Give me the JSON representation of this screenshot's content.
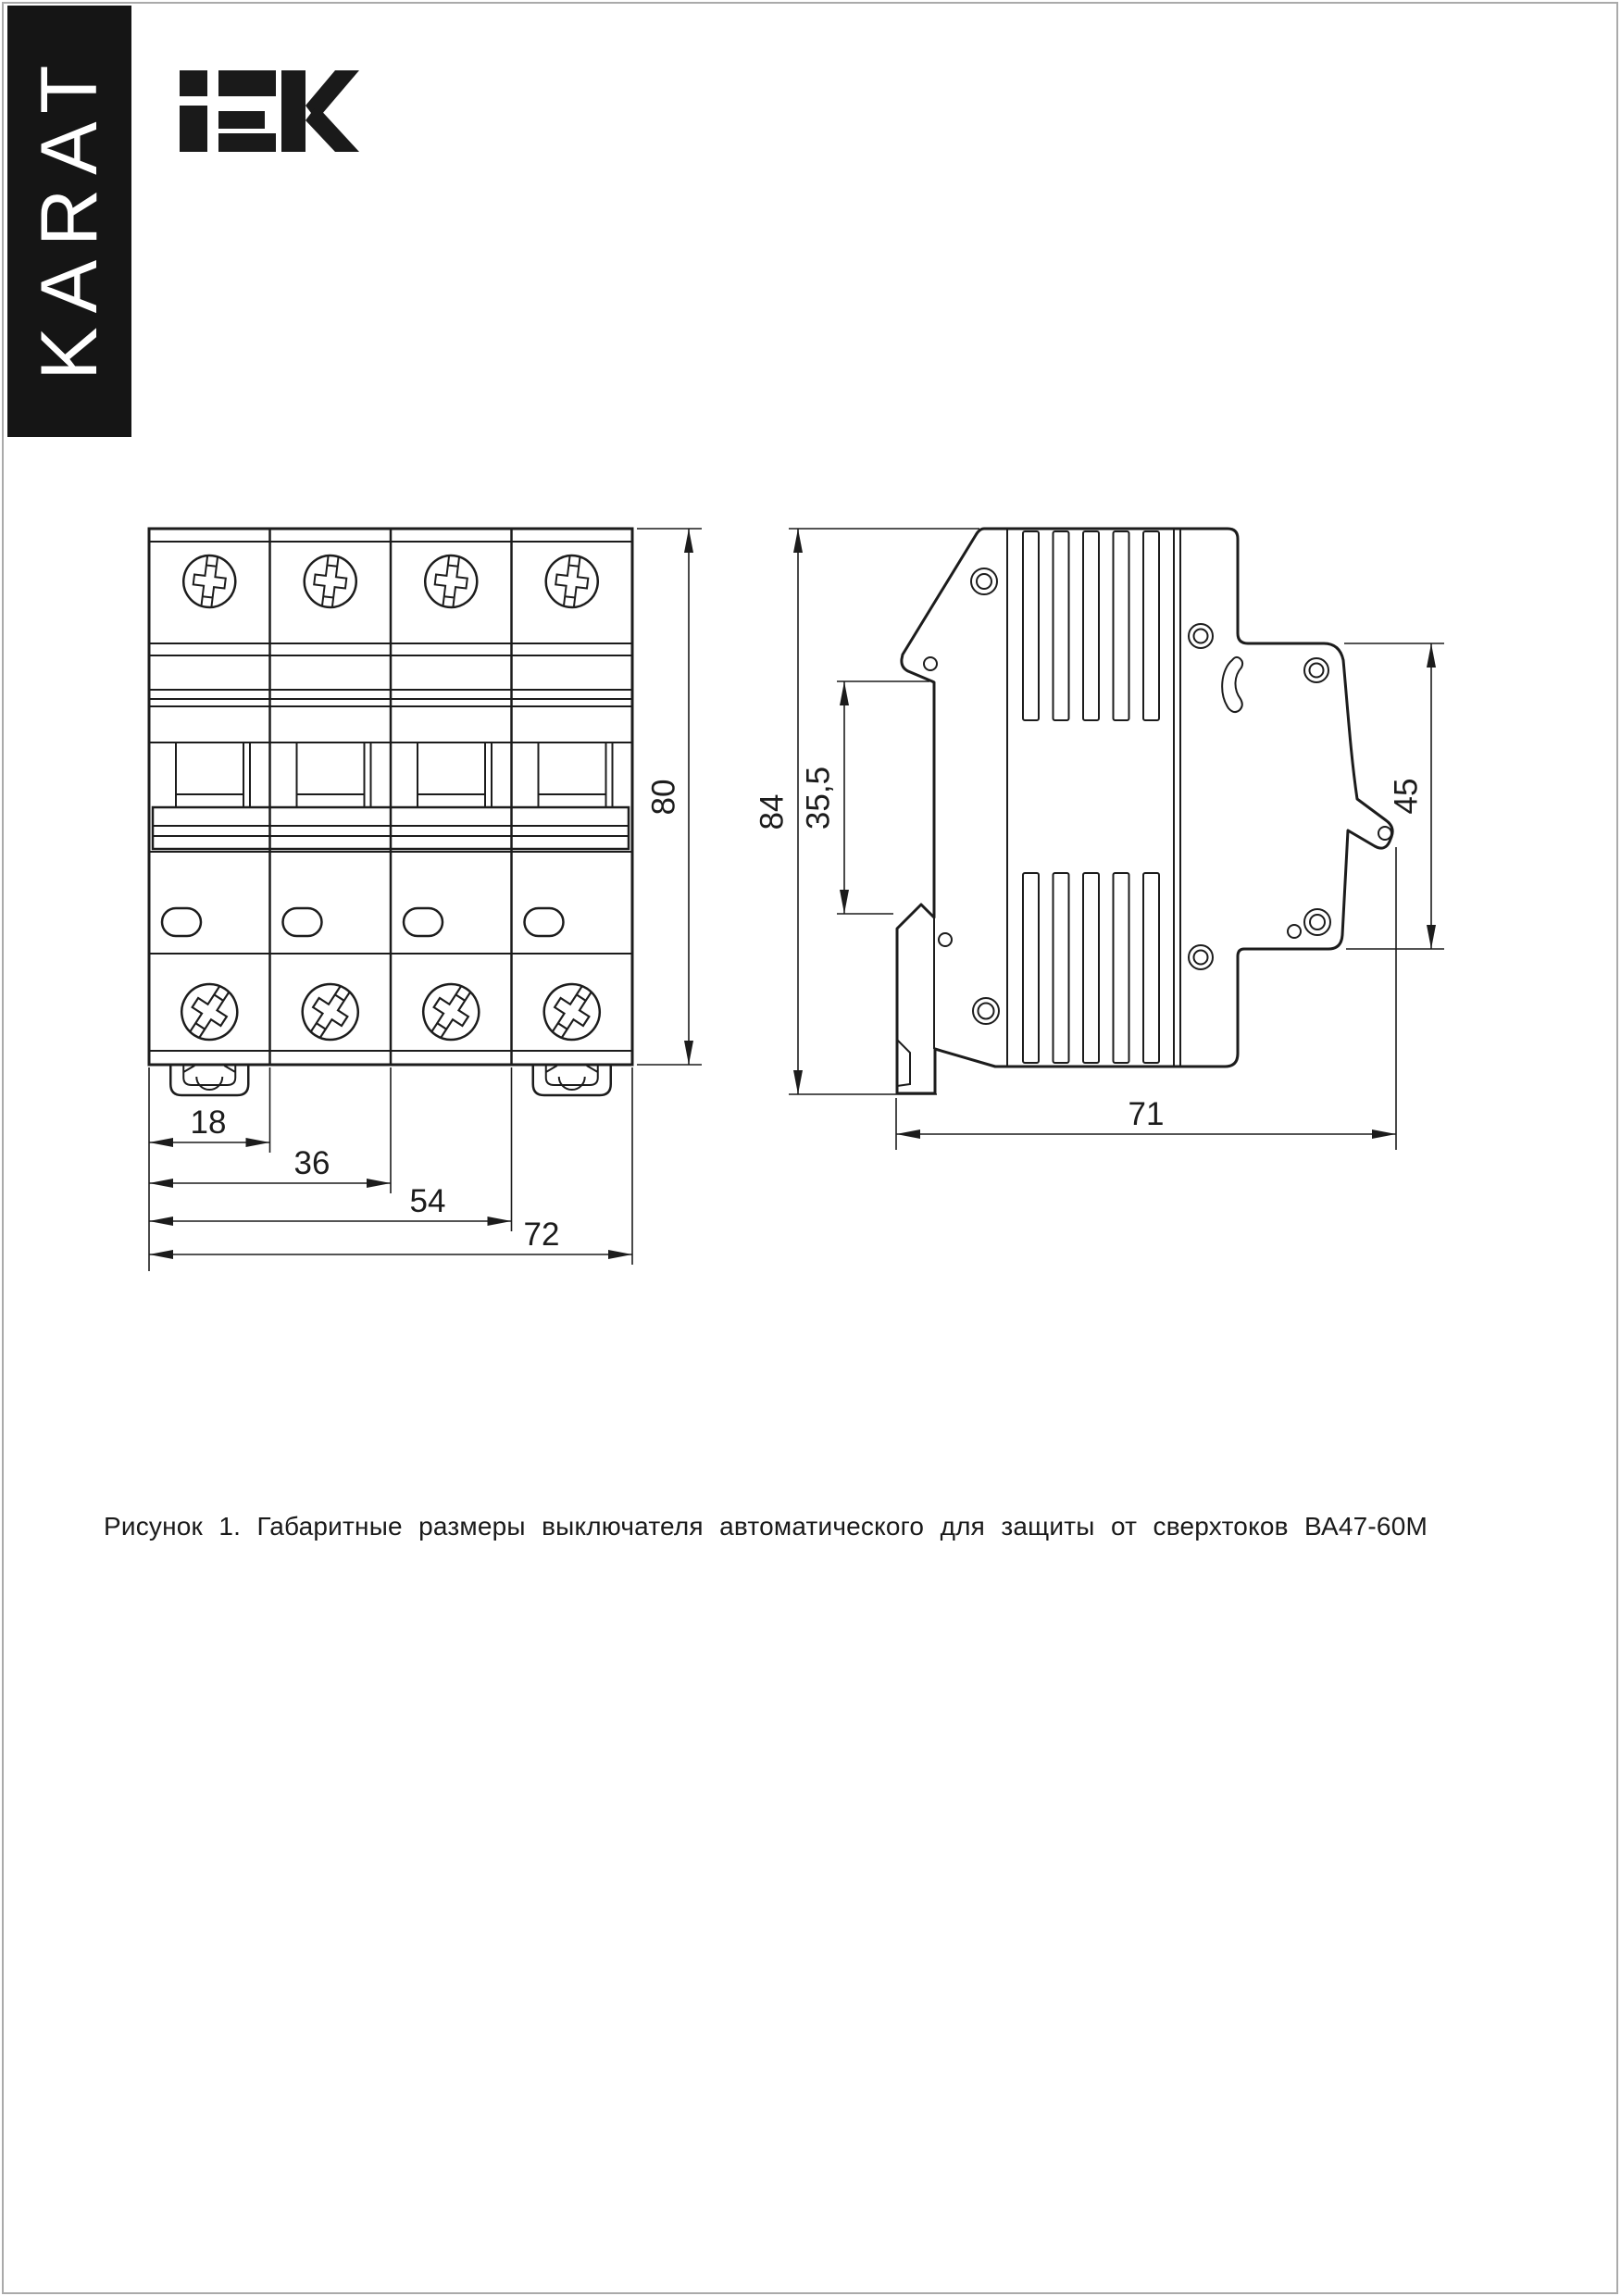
{
  "branding": {
    "karat_vertical_label": "KARAT",
    "banner_bg": "#151515",
    "banner_text_color": "#ffffff",
    "logo_text": "IEK",
    "logo_color": "#1a1a1a"
  },
  "figure": {
    "caption": "Рисунок 1. Габаритные размеры выключателя автоматического для защиты от сверхтоков ВА47-60М",
    "line_color": "#1c1c1c",
    "front_view": {
      "description": "front view of 4-pole circuit breaker",
      "dims": {
        "w18": "18",
        "w36": "36",
        "w54": "54",
        "w72": "72",
        "height": "80"
      }
    },
    "side_view": {
      "description": "side view of circuit breaker",
      "dims": {
        "height": "84",
        "rail_window": "35,5",
        "face_height": "45",
        "depth": "71"
      }
    }
  }
}
